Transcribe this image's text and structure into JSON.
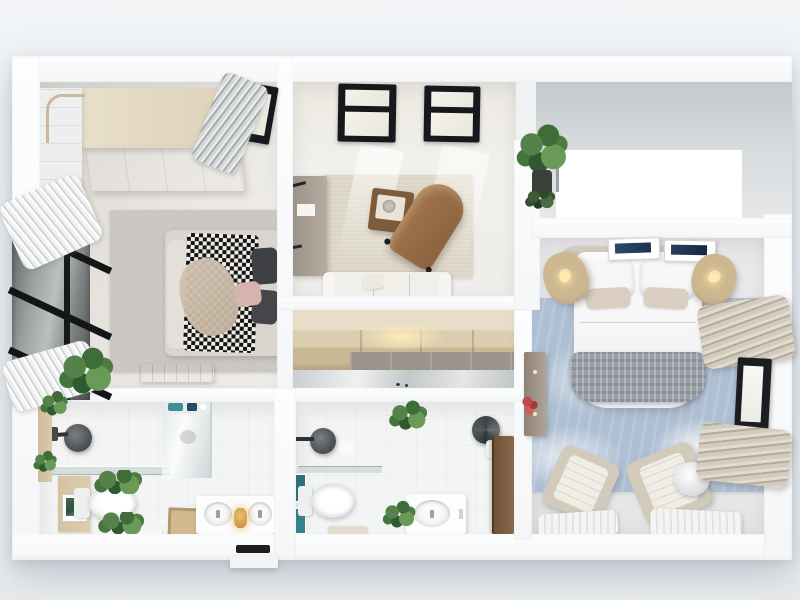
{
  "scene": {
    "title": "Top-down 3D render of an apartment floor plan",
    "style": "photorealistic dollhouse view, no text labels rendered",
    "rooms": {
      "bedroom": {
        "name": "Bedroom",
        "items": [
          "built-in wood wardrobe",
          "corner shelf with rail",
          "double bed with houndstooth-check throw",
          "dark head pillows",
          "pink pillow",
          "gray area rug",
          "wood bench",
          "black-framed glass partition wall",
          "pleated white curtains",
          "silver pleated curtain",
          "skylight",
          "potted plant"
        ]
      },
      "living_room": {
        "name": "Living Room",
        "items": [
          "two black-framed skylights",
          "white sofa with cushions",
          "brown chaise lounge",
          "square wood coffee table with tray",
          "beige area rug",
          "wall-mounted desk with lamp",
          "glossy tile floor",
          "tall potted plant"
        ]
      },
      "master_bedroom": {
        "name": "Master Bedroom",
        "items": [
          "double bed with white duvet",
          "gray knit throw",
          "upholstered headboard",
          "two rattan pendant lamps",
          "two framed artworks",
          "blue marble rug",
          "slim dresser with red flowers",
          "two lounge chairs",
          "round white floor lamp",
          "two white floor throws",
          "beige bunched curtains",
          "black-framed window"
        ]
      },
      "hallway": {
        "name": "Hallway",
        "items": [
          "built-in wood closet with warm light",
          "mirror panel"
        ]
      },
      "bathroom_main": {
        "name": "Main Bathroom",
        "items": [
          "walk-in shower with glass screen",
          "black rain shower head",
          "glass shelf",
          "toilet",
          "double-sink vanity",
          "amber vanity lamp",
          "wood bath mat",
          "wood board with framed print",
          "green plants",
          "shelf with teal accessories",
          "white towel"
        ]
      },
      "bathroom_second": {
        "name": "Second Bathroom",
        "items": [
          "walk-in shower",
          "black shower head",
          "toilet",
          "single-sink vanity",
          "floor plant",
          "hanging plant",
          "teal wall prints",
          "round water heater",
          "wood door",
          "bath mat"
        ]
      },
      "entry": {
        "name": "Entry",
        "items": [
          "front-door threshold",
          "outside step"
        ]
      },
      "cutout": {
        "name": "Clipped white region",
        "items": [
          "unrendered white rectangle"
        ]
      }
    },
    "palette": {
      "background": "#e9edf1",
      "walls": "#fbfcfd",
      "wood_light": "#dfd3b8",
      "wood_medium": "#a97e52",
      "wood_dark": "#7a5b3e",
      "rug_gray": "#c9c5c0",
      "rug_beige": "#dbd5c5",
      "rug_blue_marble": "#aebfd3",
      "checker_dark": "#161616",
      "glass_dark": "#4c5152",
      "greenery": "#4b7a44",
      "teal_accent": "#3f8f99",
      "amber_accent": "#daa54e",
      "flower_red": "#c14949",
      "throw_gray": "#9aa0a7",
      "skylight_frame": "#17181c"
    }
  }
}
